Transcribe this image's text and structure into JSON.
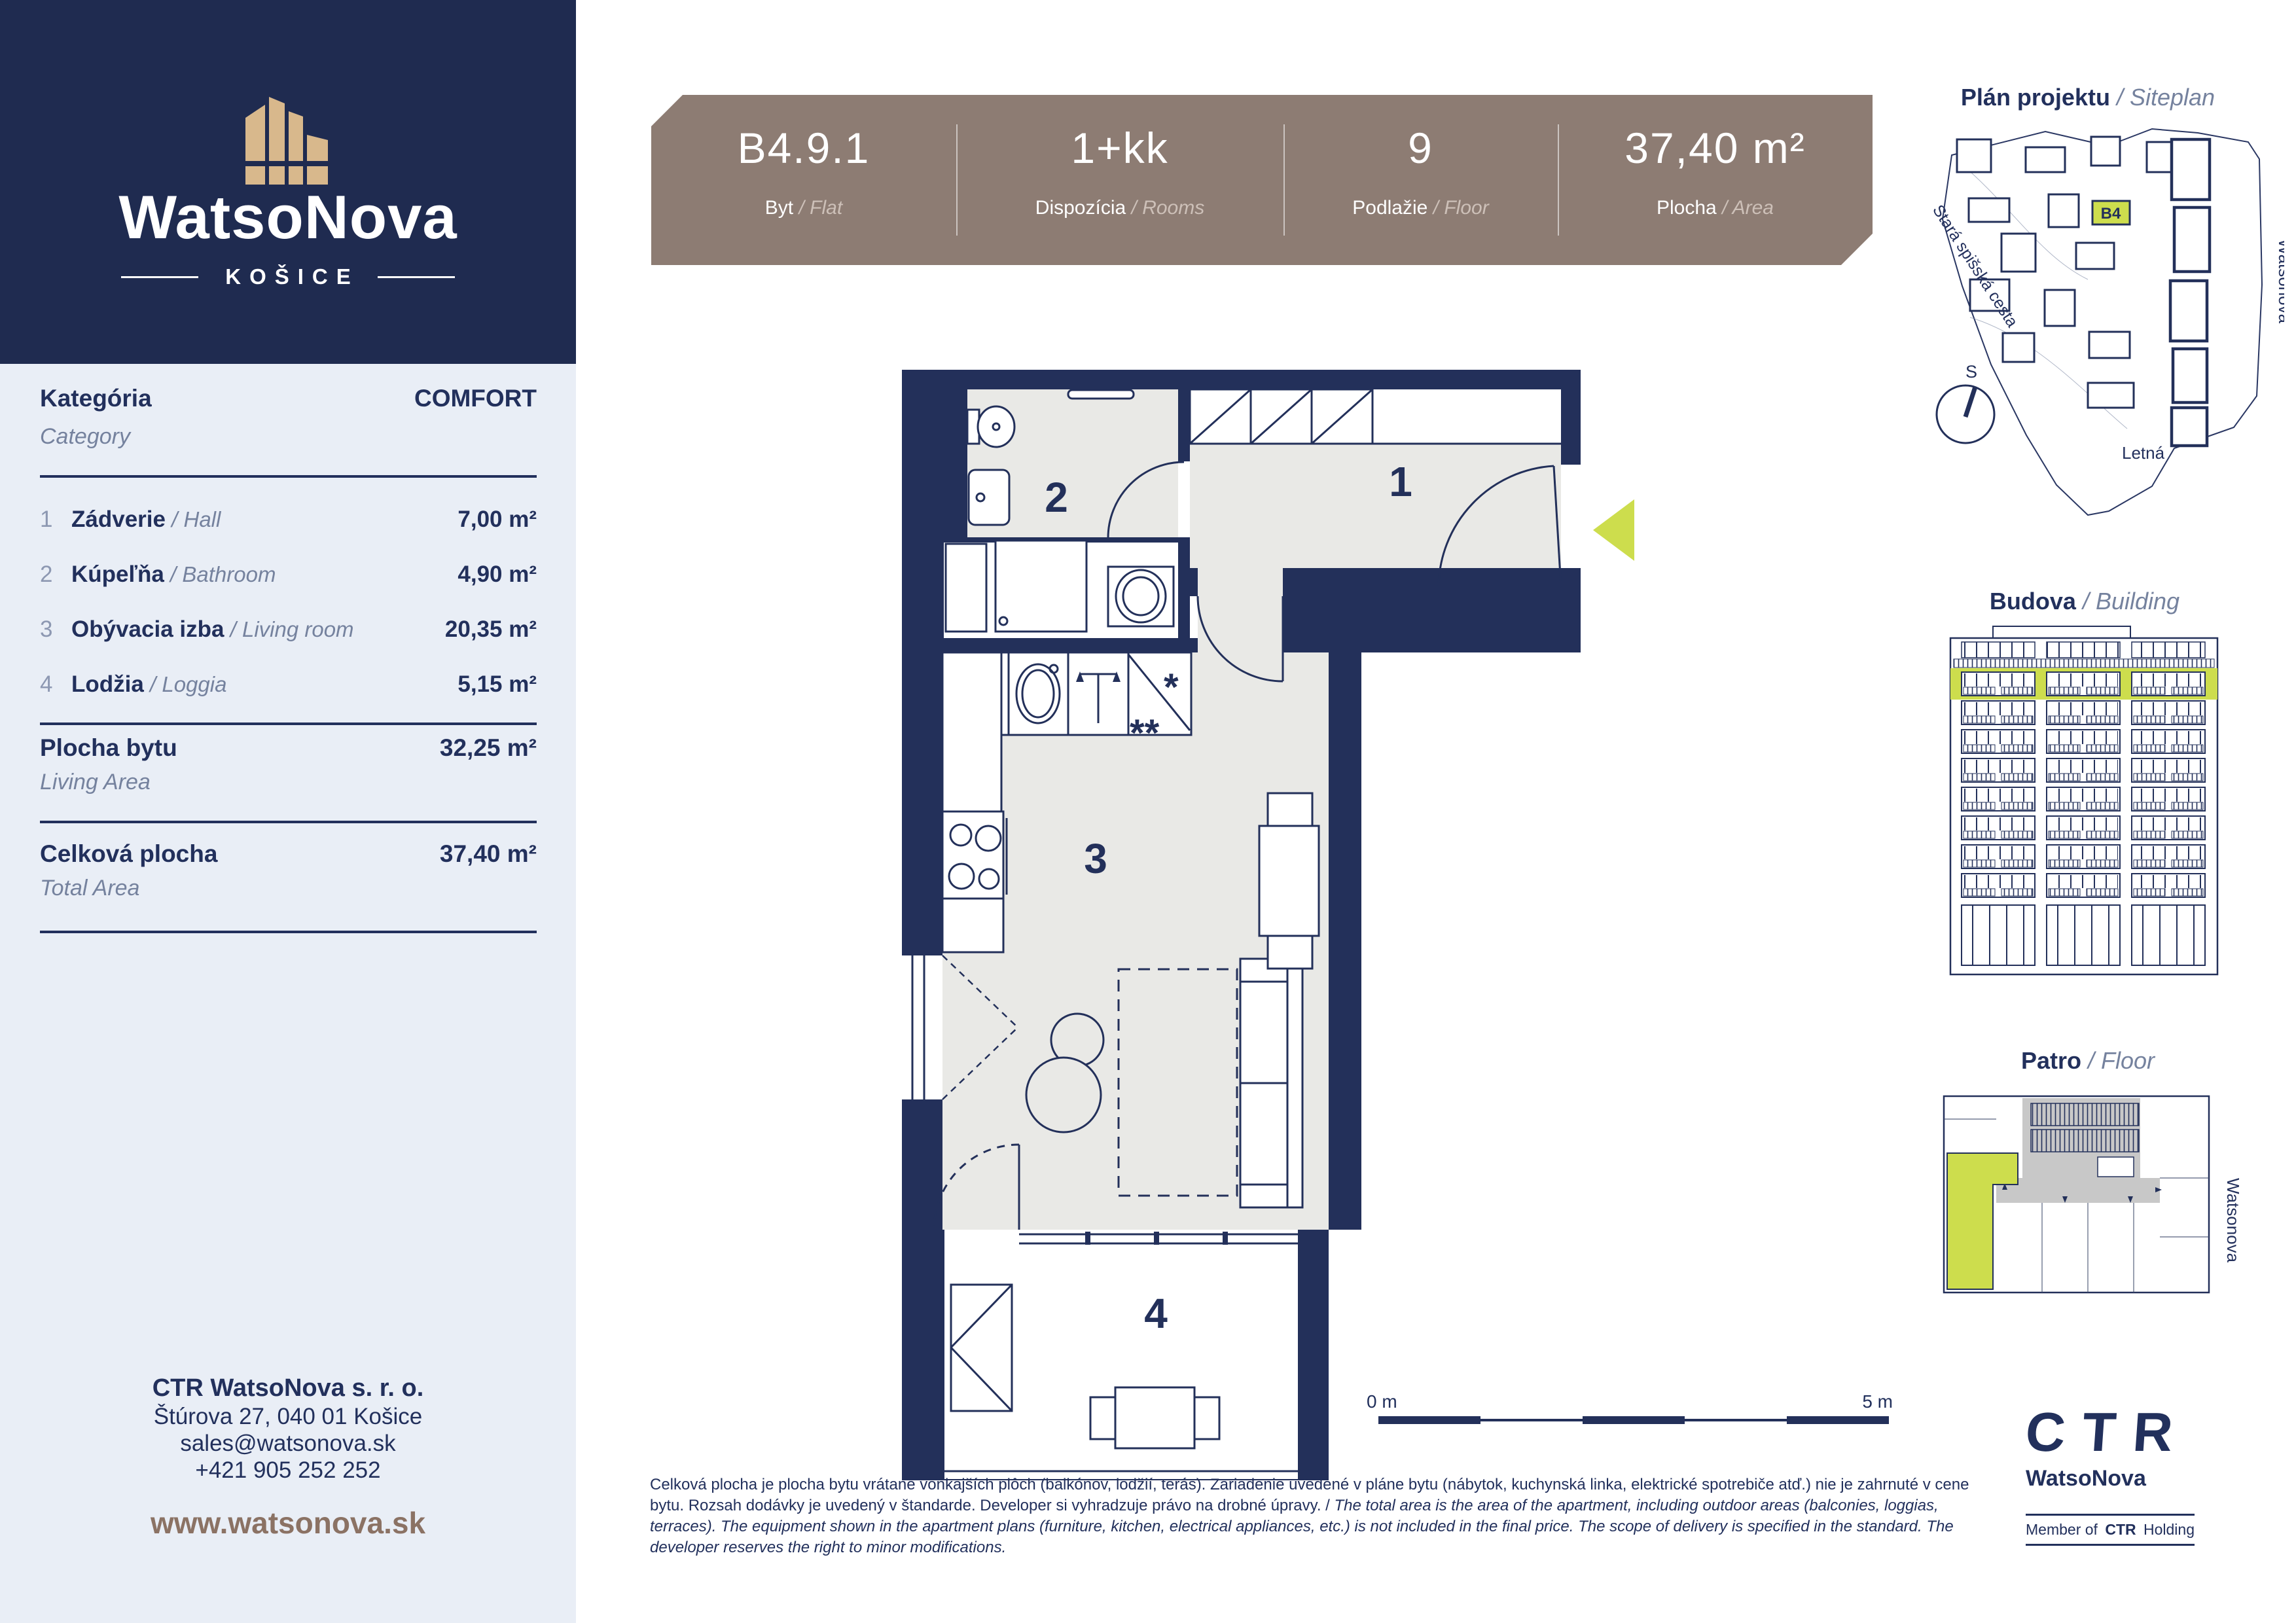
{
  "colors": {
    "navy": "#22305c",
    "panel": "#1f2b50",
    "sidebar_bg": "#e9eef6",
    "banner": "#8d7c73",
    "banner_muted": "#cdc0b8",
    "green": "#cddd4d",
    "floor_gray": "#e9e9e6",
    "brown": "#8b7264",
    "tan": "#d8b88c"
  },
  "brand": {
    "logo_title": "WatsoNova",
    "logo_city": "KOŠICE"
  },
  "banner": {
    "cols": [
      {
        "value": "B4.9.1",
        "sk": "Byt",
        "en": "Flat"
      },
      {
        "value": "1+kk",
        "sk": "Dispozícia",
        "en": "Rooms"
      },
      {
        "value": "9",
        "sk": "Podlažie",
        "en": "Floor"
      },
      {
        "value": "37,40 m²",
        "sk": "Plocha",
        "en": "Area"
      }
    ]
  },
  "sidebar": {
    "category": {
      "sk": "Kategória",
      "en": "Category",
      "value": "COMFORT"
    },
    "rooms": [
      {
        "num": "1",
        "name_sk": "Zádverie",
        "name_en": "Hall",
        "area": "7,00 m²"
      },
      {
        "num": "2",
        "name_sk": "Kúpeľňa",
        "name_en": "Bathroom",
        "area": "4,90 m²"
      },
      {
        "num": "3",
        "name_sk": "Obývacia izba",
        "name_en": "Living room",
        "area": "20,35 m²"
      },
      {
        "num": "4",
        "name_sk": "Lodžia",
        "name_en": "Loggia",
        "area": "5,15 m²"
      }
    ],
    "living_area": {
      "sk": "Plocha bytu",
      "en": "Living Area",
      "value": "32,25 m²"
    },
    "total_area": {
      "sk": "Celková plocha",
      "en": "Total Area",
      "value": "37,40 m²"
    },
    "contact": {
      "company": "CTR WatsoNova s. r. o.",
      "address": "Štúrova 27, 040 01 Košice",
      "email": "sales@watsonova.sk",
      "phone": "+421 905 252 252",
      "web": "www.watsonova.sk"
    }
  },
  "floorplan": {
    "labels": {
      "hall": "1",
      "bath": "2",
      "living": "3",
      "loggia": "4"
    },
    "scale": {
      "start": "0 m",
      "end": "5 m"
    }
  },
  "siteplan": {
    "title_sk": "Plán projektu",
    "title_en": "Siteplan",
    "unit": "B4",
    "compass": "S",
    "street_old": "Stará spišská cesta",
    "street_watsonova": "Watsonova",
    "street_letna": "Letná"
  },
  "building": {
    "title_sk": "Budova",
    "title_en": "Building"
  },
  "floor": {
    "title_sk": "Patro",
    "title_en": "Floor",
    "street": "Watsonova"
  },
  "footer": {
    "disclaimer_sk": "Celková plocha je plocha bytu vrátane vonkajších plôch (balkónov, lodžií, terás). Zariadenie uvedené v pláne bytu (nábytok, kuchynská linka, elektrické spotrebiče atď.) nie je zahrnuté v cene bytu. Rozsah dodávky je uvedený v štandarde. Developer si vyhradzuje právo na drobné úpravy.",
    "disclaimer_en": "The total area is the area of the apartment, including outdoor areas (balconies, loggias, terraces). The equipment shown in the apartment plans (furniture, kitchen, electrical appliances, etc.) is not included in the final price. The scope of delivery is specified in the standard. The developer reserves the right to minor modifications.",
    "ctr": {
      "word": "CTR",
      "name": "WatsoNova",
      "member_pre": "Member of",
      "member_ctr": "CTR",
      "member_post": "Holding"
    }
  }
}
